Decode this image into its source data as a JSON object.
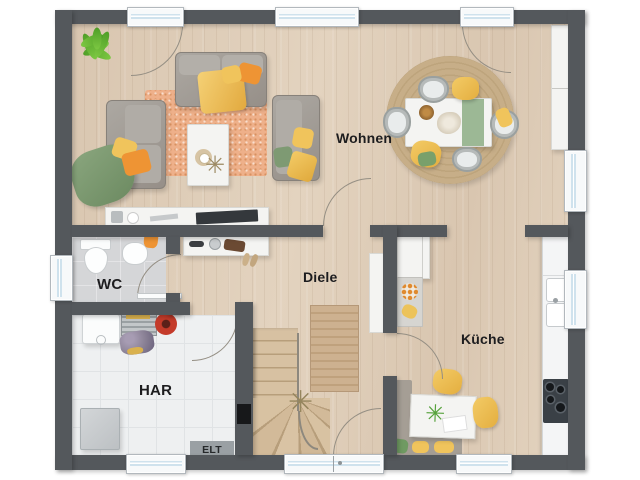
{
  "plan": {
    "type": "floor-plan-ground-floor",
    "rooms": [
      {
        "id": "wohnen",
        "label": "Wohnen"
      },
      {
        "id": "diele",
        "label": "Diele"
      },
      {
        "id": "wc",
        "label": "WC"
      },
      {
        "id": "har",
        "label": "HAR"
      },
      {
        "id": "kueche",
        "label": "Küche"
      },
      {
        "id": "elt",
        "label": "ELT"
      }
    ]
  },
  "colors": {
    "wall": "#54585c",
    "wood": "#d9c6b0",
    "woodlight": "#e3d3bf",
    "wcfloor": "#d5d6d8",
    "harfloor": "#eef0f1",
    "glass": "#cfe2ed",
    "arcline": "#948e83",
    "rugterracotta": "#eeb08a",
    "rugjute": "#c7ae88",
    "stairwood": "#d7c1a2",
    "stairedge": "#b79e7b",
    "sofagray": "#a29e99",
    "orange": "#ee9434",
    "yellow": "#f0c45c",
    "green": "#7e9a73",
    "counter": "#f4f5f6",
    "cooktop": "#3a4046",
    "eltpanel": "#9aa0a4",
    "labeltext": "#1d1d1f"
  }
}
